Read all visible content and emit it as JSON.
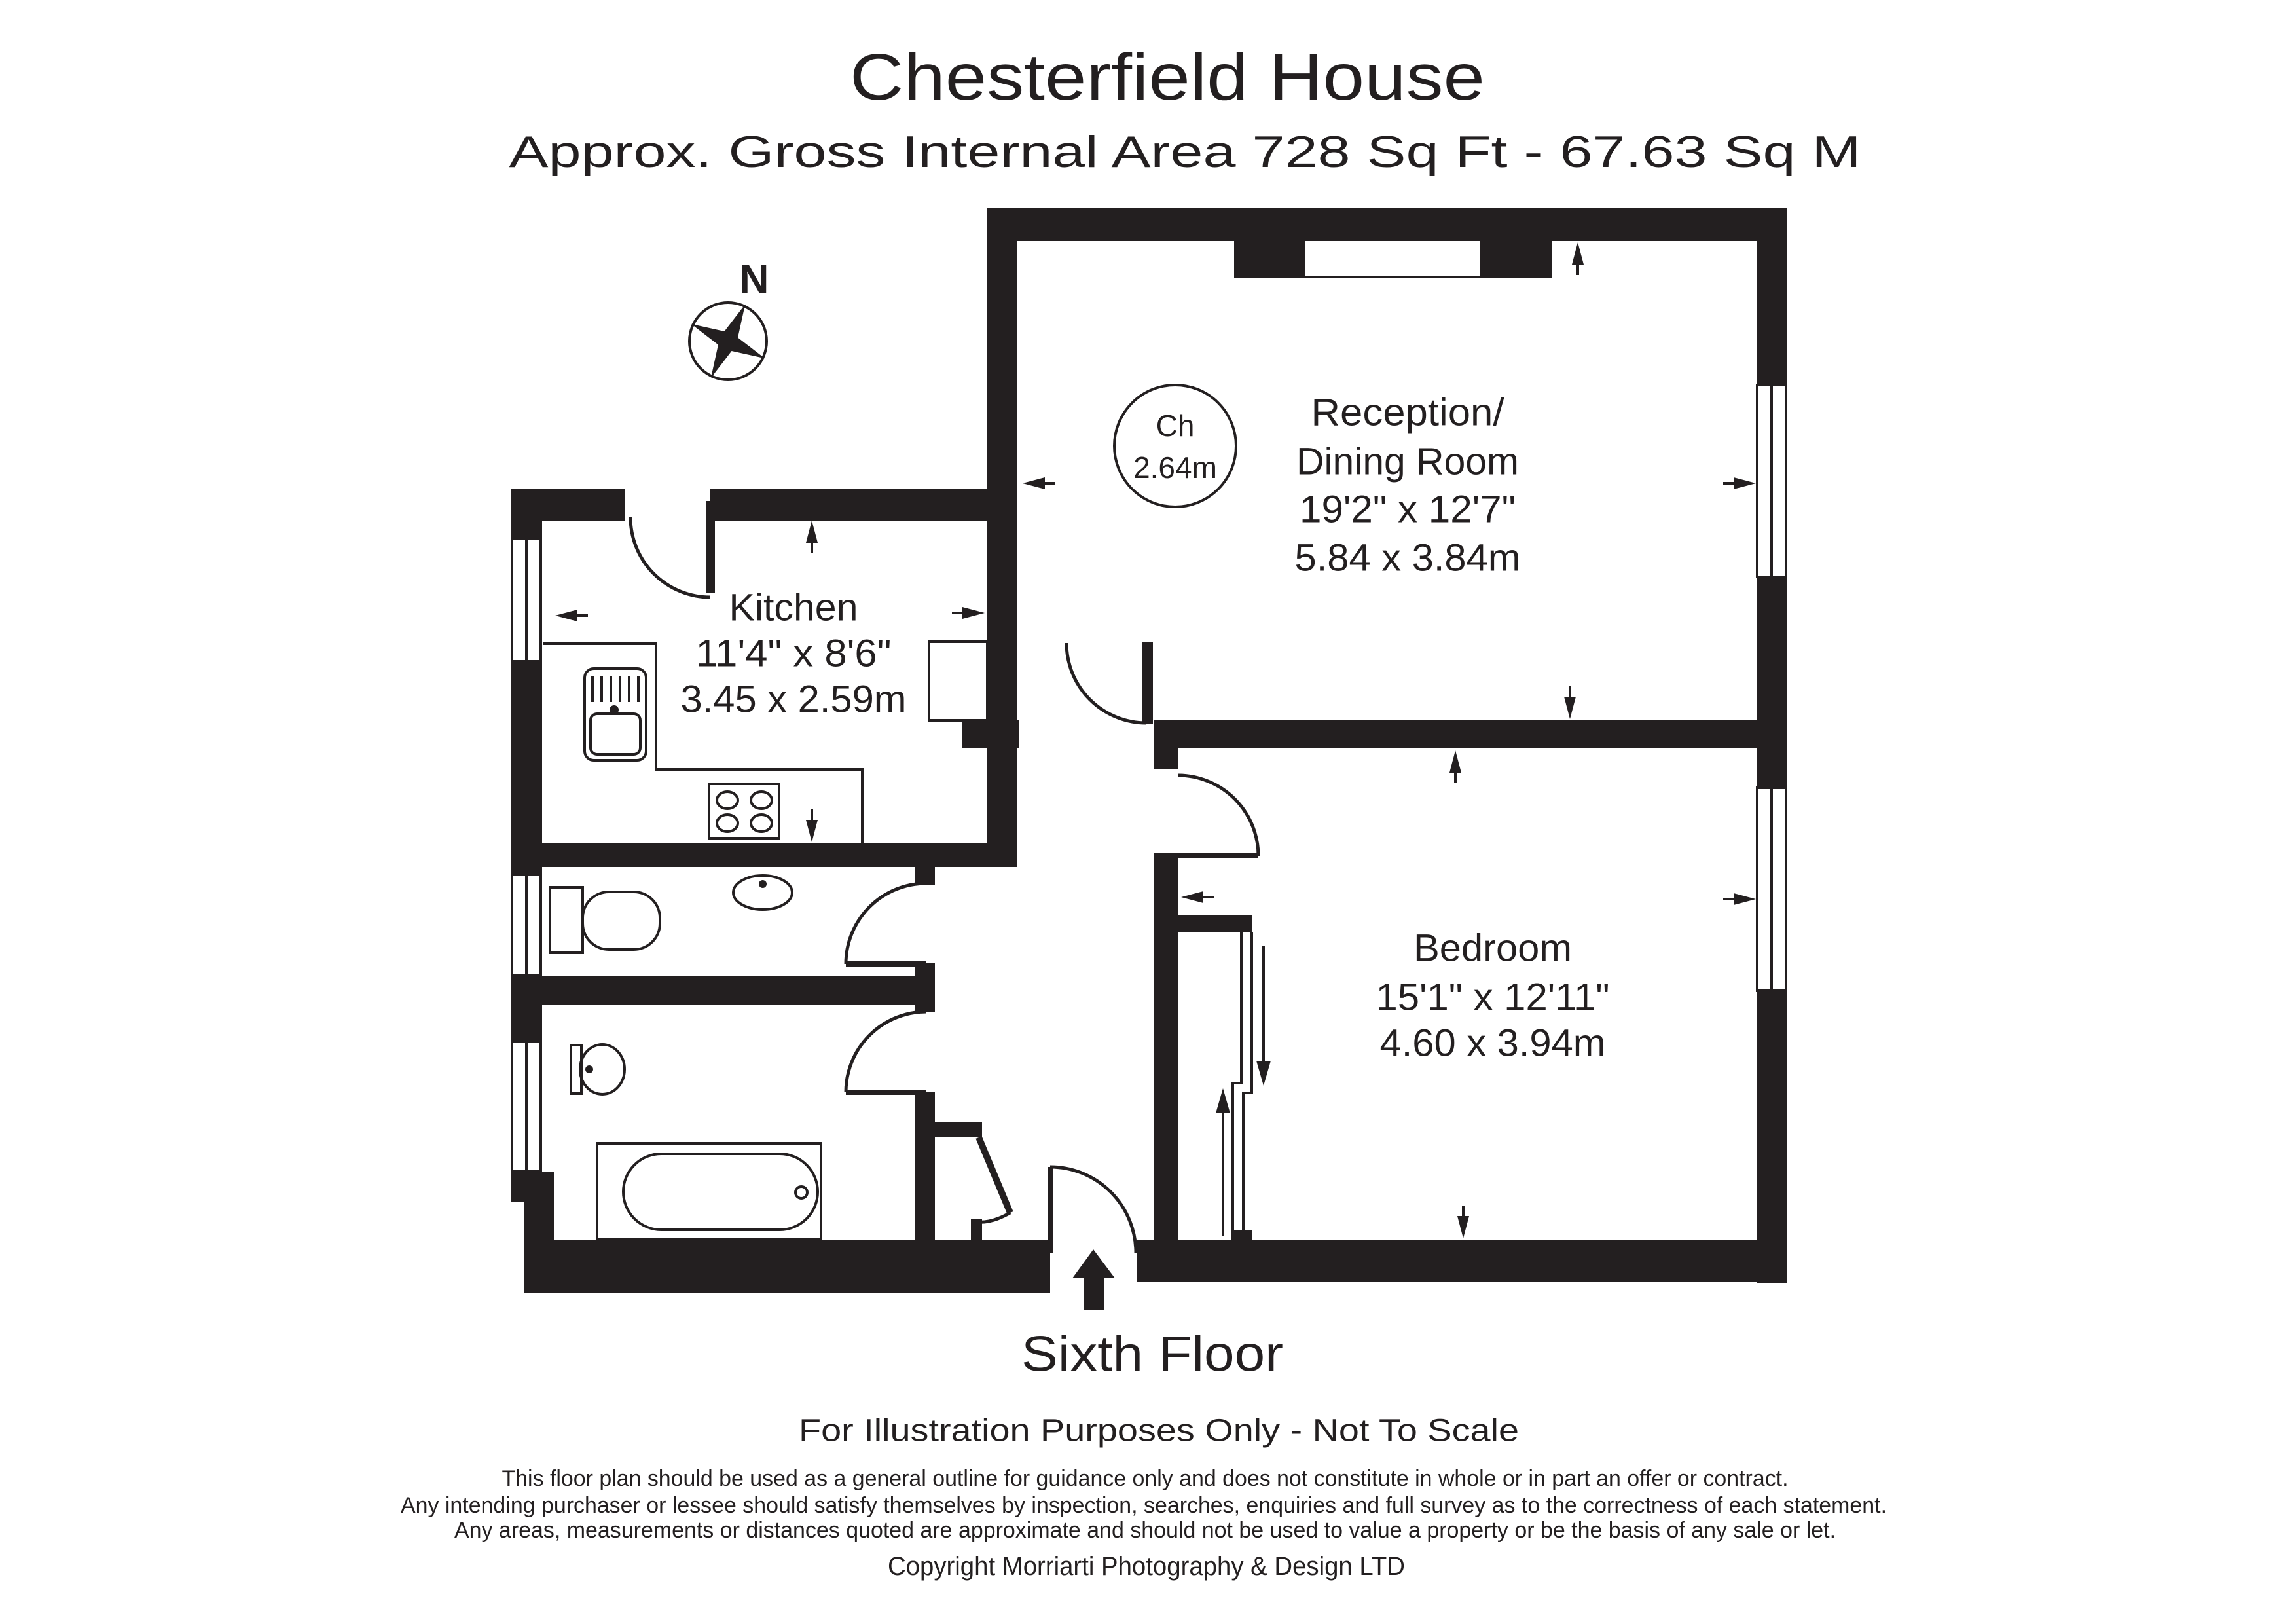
{
  "header": {
    "title": "Chesterfield House",
    "subtitle": "Approx. Gross Internal Area  728 Sq Ft  -  67.63 Sq M"
  },
  "compass": {
    "north_label": "N"
  },
  "ceiling_height_badge": {
    "line1": "Ch",
    "line2": "2.64m"
  },
  "rooms": {
    "reception": {
      "name_line1": "Reception/",
      "name_line2": "Dining Room",
      "size_imperial": "19'2\" x 12'7\"",
      "size_metric": "5.84 x 3.84m"
    },
    "kitchen": {
      "name_line1": "Kitchen",
      "size_imperial": "11'4\" x 8'6\"",
      "size_metric": "3.45 x 2.59m"
    },
    "bedroom": {
      "name_line1": "Bedroom",
      "size_imperial": "15'1\" x 12'11\"",
      "size_metric": "4.60 x 3.94m"
    }
  },
  "floor_label": "Sixth Floor",
  "scale_note": "For Illustration Purposes Only - Not To Scale",
  "disclaimer": {
    "line1": "This floor plan should be used as a general outline for guidance only and does not constitute in whole or in part an offer or contract.",
    "line2": "Any intending purchaser or lessee should satisfy themselves by inspection, searches, enquiries and full survey as to the correctness of each statement.",
    "line3": "Any areas, measurements or distances quoted are approximate and should not be used to value a property or be the basis of any sale or let."
  },
  "copyright": "Copyright Morriarti Photography & Design LTD",
  "colors": {
    "ink": "#231f20",
    "background": "#ffffff"
  }
}
